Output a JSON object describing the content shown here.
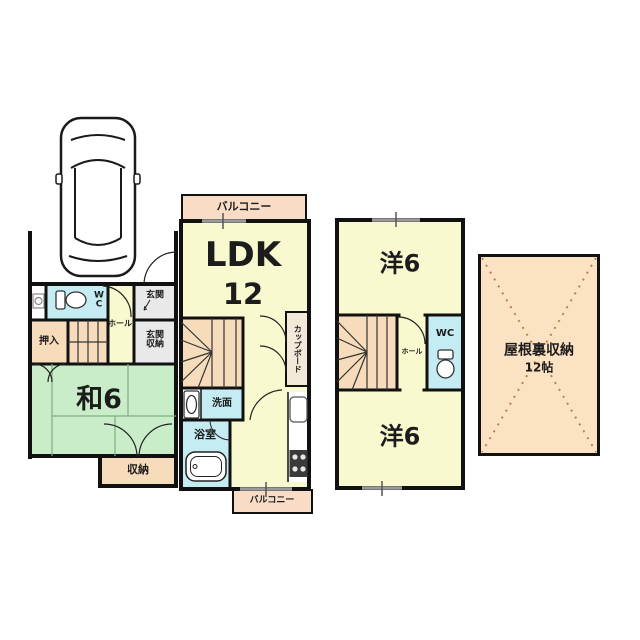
{
  "floor1": {
    "wc": "WC",
    "oshiire": "押入",
    "hall": "ホール",
    "genkan": "玄関",
    "genkan_storage": "玄関収納",
    "washitsu": "和6",
    "storage": "収納"
  },
  "floor2": {
    "balcony_top": "バルコニー",
    "ldk": "LDK",
    "ldk_size": "12",
    "cupboard": "カップボード",
    "senmen": "洗面",
    "bath": "浴室",
    "balcony_bottom": "バルコニー"
  },
  "floor3": {
    "room_top": "洋6",
    "hall": "ホール",
    "wc": "WC",
    "room_bottom": "洋6"
  },
  "attic": {
    "name": "屋根裏収納",
    "size": "12帖"
  },
  "colors": {
    "room_yellow": "#f9f9cf",
    "tatami_green": "#c9edc9",
    "closet_peach": "#f6dcbb",
    "balcony_peach": "#f8dcc6",
    "water_blue": "#c5ecf2",
    "entry_gray": "#e9e9e9",
    "attic_peach": "#fbe2c2",
    "wall": "#111111"
  }
}
